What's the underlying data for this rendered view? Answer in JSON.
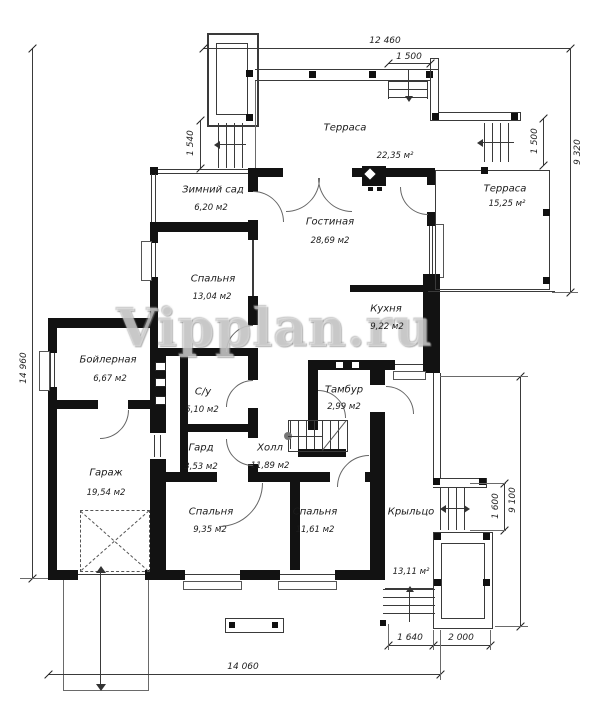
{
  "watermark": "Vipplan.ru",
  "rooms": [
    {
      "name": "Зимний сад",
      "area": "6,20 м2"
    },
    {
      "name": "Гостиная",
      "area": "28,69 м2"
    },
    {
      "name": "Спальня",
      "area": "13,04 м2"
    },
    {
      "name": "Кухня",
      "area": "9,22 м2"
    },
    {
      "name": "Бойлерная",
      "area": "6,67 м2"
    },
    {
      "name": "С/у",
      "area": "5,10 м2"
    },
    {
      "name": "Гард",
      "area": "3,53 м2"
    },
    {
      "name": "Холл",
      "area": "11,89 м2"
    },
    {
      "name": "Тамбур",
      "area": "2,99 м2"
    },
    {
      "name": "Гараж",
      "area": "19,54 м2"
    },
    {
      "name": "Спальня",
      "area": "9,35 м2"
    },
    {
      "name": "Спальня",
      "area": "11,61 м2"
    },
    {
      "name": "Крыльцо",
      "area": "13,11 м²"
    },
    {
      "name": "Терраса",
      "area": "22,35 м²"
    },
    {
      "name": "Терраса",
      "area": "15,25 м²"
    }
  ],
  "dimensions": {
    "top_width": "12 460",
    "top_stair_width": "1 500",
    "left_stair_width": "1 540",
    "right_upper_height": "9 320",
    "right_stair_width": "1 500",
    "right_lower_height": "9 100",
    "porch_stair_width": "1 600",
    "left_height": "14 960",
    "bottom_width": "14 060",
    "bottom_seg1": "1 640",
    "bottom_seg2": "2 000"
  }
}
